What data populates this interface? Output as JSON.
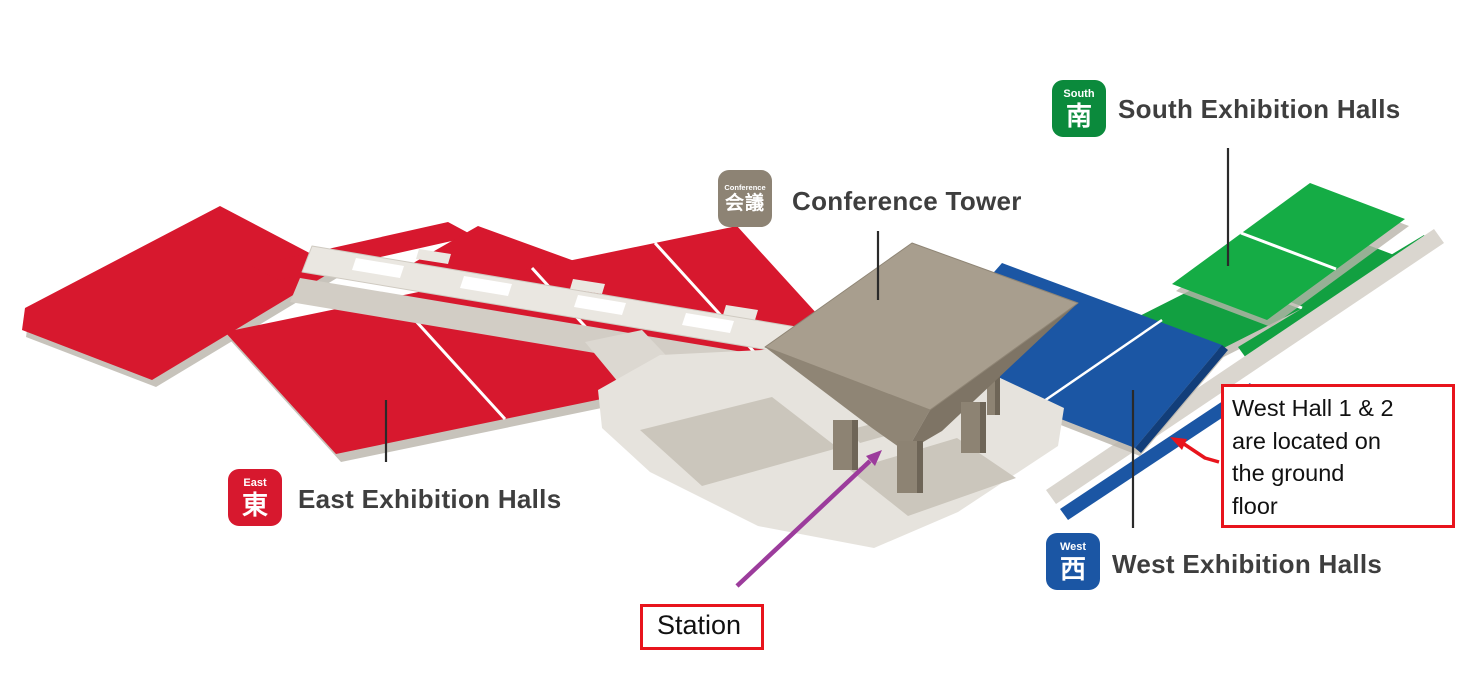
{
  "venues": {
    "east": {
      "badge_label": "East",
      "badge_kanji": "東",
      "title": "East Exhibition Halls"
    },
    "west": {
      "badge_label": "West",
      "badge_kanji": "西",
      "title": "West Exhibition Halls"
    },
    "south": {
      "badge_label": "South",
      "badge_kanji": "南",
      "title": "South Exhibition Halls"
    },
    "conference": {
      "badge_label": "Conference",
      "badge_kanji": "会議",
      "title": "Conference Tower"
    }
  },
  "annotations": {
    "station_label": "Station",
    "west_hall_note": "West Hall 1 & 2\nare located on\nthe ground\nfloor"
  },
  "colors": {
    "east_red": "#D7182E",
    "west_blue": "#1B56A4",
    "south_green": "#0FA63F",
    "conference_taupe": "#8D8374",
    "walkway_gray": "#E6E3DD",
    "annotation_red": "#E8141C",
    "station_arrow_purple": "#9C3C9C",
    "title_text": "#3E3E3E"
  }
}
